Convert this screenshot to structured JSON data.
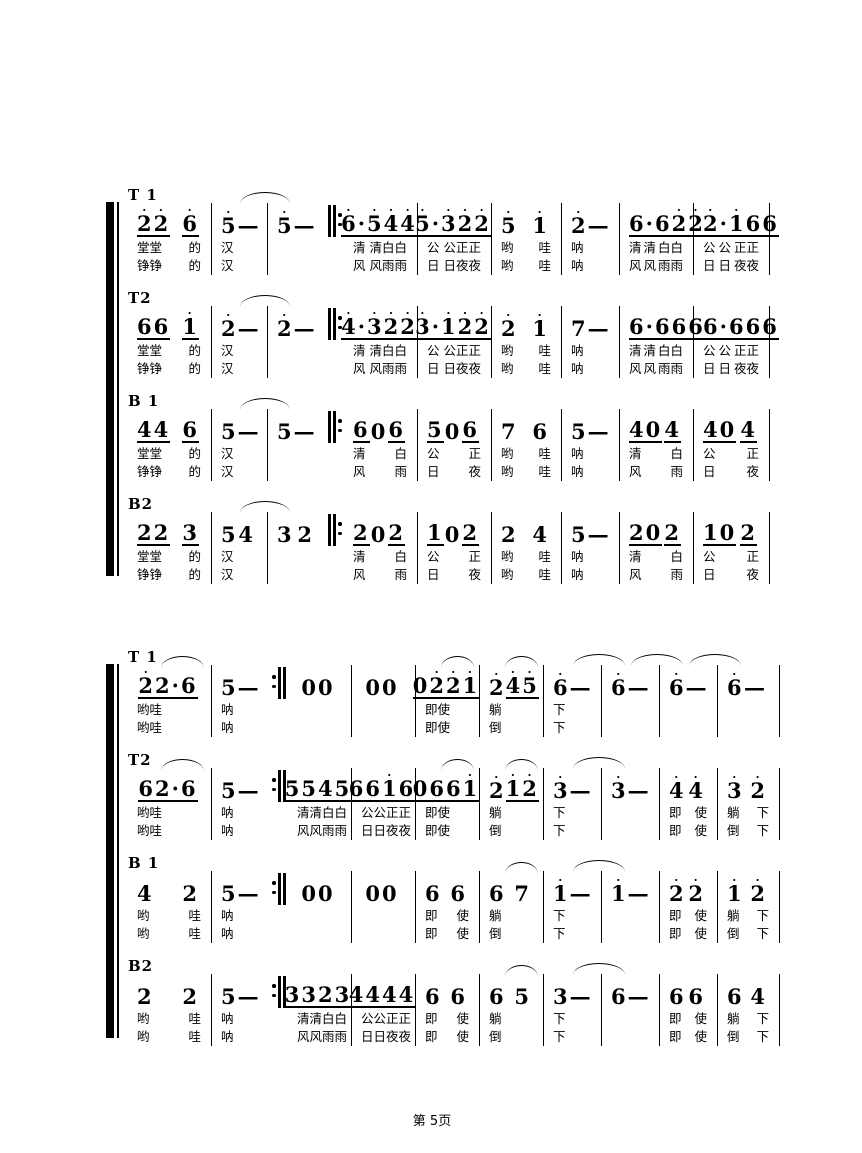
{
  "page": {
    "footer": "第 5页",
    "background": "#ffffff",
    "ink": "#000000"
  },
  "systems": [
    {
      "name": "system-1",
      "repeat": {
        "after": 3,
        "type": "start"
      },
      "parts": [
        {
          "label": "T 1",
          "measures": [
            {
              "n": "2'2'_ 6'_",
              "l1": "堂堂 的",
              "l2": "铮铮 的"
            },
            {
              "n": "5' —",
              "arc": "next",
              "l1": "汉",
              "l2": "汉"
            },
            {
              "n": "5' —"
            },
            {
              "n": "6'·5'4'4'_",
              "l1": "清 清白白",
              "l2": "风 风雨雨"
            },
            {
              "n": "5'·3'2'2'_",
              "l1": "公 公正正",
              "l2": "日 日夜夜"
            },
            {
              "n": "5' 1'",
              "l1": "哟 哇",
              "l2": "哟 哇"
            },
            {
              "n": "2' —",
              "l1": "呐",
              "l2": "呐"
            },
            {
              "n": "6·6_ 2'2'_",
              "l1": "清 清 白白",
              "l2": "风 风 雨雨"
            },
            {
              "n": "2'·1'_ 66_",
              "l1": "公 公 正正",
              "l2": "日 日 夜夜"
            }
          ]
        },
        {
          "label": "T2",
          "measures": [
            {
              "n": "66_ 1'_",
              "l1": "堂堂 的",
              "l2": "铮铮 的"
            },
            {
              "n": "2' —",
              "arc": "next",
              "l1": "汉",
              "l2": "汉"
            },
            {
              "n": "2' —"
            },
            {
              "n": "4'·3'2'2'_",
              "l1": "清 清白白",
              "l2": "风 风雨雨"
            },
            {
              "n": "3'·1'2'2'_",
              "l1": "公 公正正",
              "l2": "日 日夜夜"
            },
            {
              "n": "2' 1'",
              "l1": "哟 哇",
              "l2": "哟 哇"
            },
            {
              "n": "7 —",
              "l1": "呐",
              "l2": "呐"
            },
            {
              "n": "6·6_ 66_",
              "l1": "清 清 白白",
              "l2": "风 风 雨雨"
            },
            {
              "n": "6·6_ 66_",
              "l1": "公 公 正正",
              "l2": "日 日 夜夜"
            }
          ]
        },
        {
          "label": "B 1",
          "measures": [
            {
              "n": "44_ 6_",
              "l1": "堂堂 的",
              "l2": "铮铮 的"
            },
            {
              "n": "5 —",
              "arc": "next",
              "l1": "汉",
              "l2": "汉"
            },
            {
              "n": "5 —"
            },
            {
              "n": "6_ 0 6_",
              "l1": "清 白",
              "l2": "风 雨"
            },
            {
              "n": "5_ 0 6_",
              "l1": "公 正",
              "l2": "日 夜"
            },
            {
              "n": "7 6",
              "l1": "哟 哇",
              "l2": "哟 哇"
            },
            {
              "n": "5 —",
              "l1": "呐",
              "l2": "呐"
            },
            {
              "n": "40_ 4_",
              "l1": "清 白",
              "l2": "风 雨"
            },
            {
              "n": "40_ 4_",
              "l1": "公 正",
              "l2": "日 夜"
            }
          ]
        },
        {
          "label": "B2",
          "measures": [
            {
              "n": "22_ 3_",
              "l1": "堂堂 的",
              "l2": "铮铮 的"
            },
            {
              "n": "5 4",
              "arc": "next",
              "l1": "汉",
              "l2": "汉"
            },
            {
              "n": "3 2"
            },
            {
              "n": "2_ 0 2_",
              "l1": "清 白",
              "l2": "风 雨"
            },
            {
              "n": "1_ 0 2_",
              "l1": "公 正",
              "l2": "日 夜"
            },
            {
              "n": "2 4",
              "l1": "哟 哇",
              "l2": "哟 哇"
            },
            {
              "n": "5 —",
              "l1": "呐",
              "l2": "呐"
            },
            {
              "n": "20_ 2_",
              "l1": "清 白",
              "l2": "风 雨"
            },
            {
              "n": "10_ 2_",
              "l1": "公 正",
              "l2": "日 夜"
            }
          ]
        }
      ]
    },
    {
      "name": "system-2",
      "repeat": {
        "after": 2,
        "type": "end"
      },
      "parts": [
        {
          "label": "T 1",
          "measures": [
            {
              "n": "2'2·6_",
              "arc": "in",
              "l1": "哟哇",
              "l2": "哟哇"
            },
            {
              "n": "5 —",
              "l1": "呐",
              "l2": "呐"
            },
            {
              "n": "00"
            },
            {
              "n": "00"
            },
            {
              "n": "02'2'1'_",
              "arc": "in",
              "l1": "即使",
              "l2": "即使"
            },
            {
              "n": "2' 4'5'_",
              "arc": "in",
              "l1": "躺",
              "l2": "倒"
            },
            {
              "n": "6' —",
              "arc": "next",
              "l1": "下",
              "l2": "下"
            },
            {
              "n": "6' —",
              "arc": "next"
            },
            {
              "n": "6' —",
              "arc": "next"
            },
            {
              "n": "6' —"
            }
          ]
        },
        {
          "label": "T2",
          "measures": [
            {
              "n": "62·6_",
              "arc": "in",
              "l1": "哟哇",
              "l2": "哟哇"
            },
            {
              "n": "5 —",
              "l1": "呐",
              "l2": "呐"
            },
            {
              "n": "5545_",
              "l1": "清清白白",
              "l2": "风风雨雨"
            },
            {
              "n": "661'6_",
              "l1": "公公正正",
              "l2": "日日夜夜"
            },
            {
              "n": "0661'_",
              "arc": "in",
              "l1": "即使",
              "l2": "即使"
            },
            {
              "n": "2' 1'2'_",
              "arc": "in",
              "l1": "躺",
              "l2": "倒"
            },
            {
              "n": "3' —",
              "arc": "next",
              "l1": "下",
              "l2": "下"
            },
            {
              "n": "3' —"
            },
            {
              "n": "4' 4'",
              "l1": "即 使",
              "l2": "即 使"
            },
            {
              "n": "3' 2'",
              "l1": "躺 下",
              "l2": "倒 下"
            }
          ]
        },
        {
          "label": "B 1",
          "measures": [
            {
              "n": "4 2",
              "l1": "哟 哇",
              "l2": "哟 哇"
            },
            {
              "n": "5 —",
              "l1": "呐",
              "l2": "呐"
            },
            {
              "n": "00"
            },
            {
              "n": "00"
            },
            {
              "n": "6 6",
              "l1": "即 使",
              "l2": "即 使"
            },
            {
              "n": "6 7",
              "arc": "in",
              "l1": "躺",
              "l2": "倒"
            },
            {
              "n": "1' —",
              "arc": "next",
              "l1": "下",
              "l2": "下"
            },
            {
              "n": "1' —"
            },
            {
              "n": "2' 2'",
              "l1": "即 使",
              "l2": "即 使"
            },
            {
              "n": "1' 2'",
              "l1": "躺 下",
              "l2": "倒 下"
            }
          ]
        },
        {
          "label": "B2",
          "measures": [
            {
              "n": "2 2",
              "l1": "哟 哇",
              "l2": "哟 哇"
            },
            {
              "n": "5 —",
              "l1": "呐",
              "l2": "呐"
            },
            {
              "n": "3323_",
              "l1": "清清白白",
              "l2": "风风雨雨"
            },
            {
              "n": "4444_",
              "l1": "公公正正",
              "l2": "日日夜夜"
            },
            {
              "n": "6 6",
              "l1": "即 使",
              "l2": "即 使"
            },
            {
              "n": "6 5",
              "arc": "in",
              "l1": "躺",
              "l2": "倒"
            },
            {
              "n": "3 —",
              "arc": "next",
              "l1": "下",
              "l2": "下"
            },
            {
              "n": "6 —"
            },
            {
              "n": "6 6",
              "l1": "即 使",
              "l2": "即 使"
            },
            {
              "n": "6 4",
              "l1": "躺 下",
              "l2": "倒 下"
            }
          ]
        }
      ]
    }
  ]
}
